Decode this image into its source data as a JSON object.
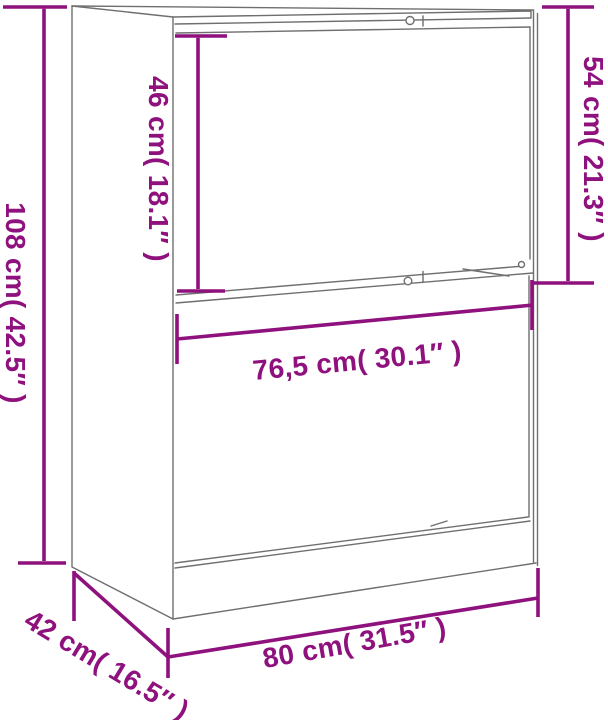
{
  "diagram": {
    "colors": {
      "dimension": "#8E117D",
      "outline": "#6F6F6F",
      "background": "#FFFFFF"
    },
    "labels": {
      "total_height": "108 cm( 42.5″ )",
      "upper_door_height": "46 cm( 18.1″ )",
      "upper_section_height": "54 cm( 21.3″ )",
      "drawer_front_width": "76,5 cm( 30.1″ )",
      "total_width": "80 cm( 31.5″ )",
      "depth": "42 cm( 16.5″ )"
    },
    "icons": [
      "top-knob-circle-icon",
      "middle-knob-circle-icon",
      "right-peg-circle-icon"
    ]
  }
}
